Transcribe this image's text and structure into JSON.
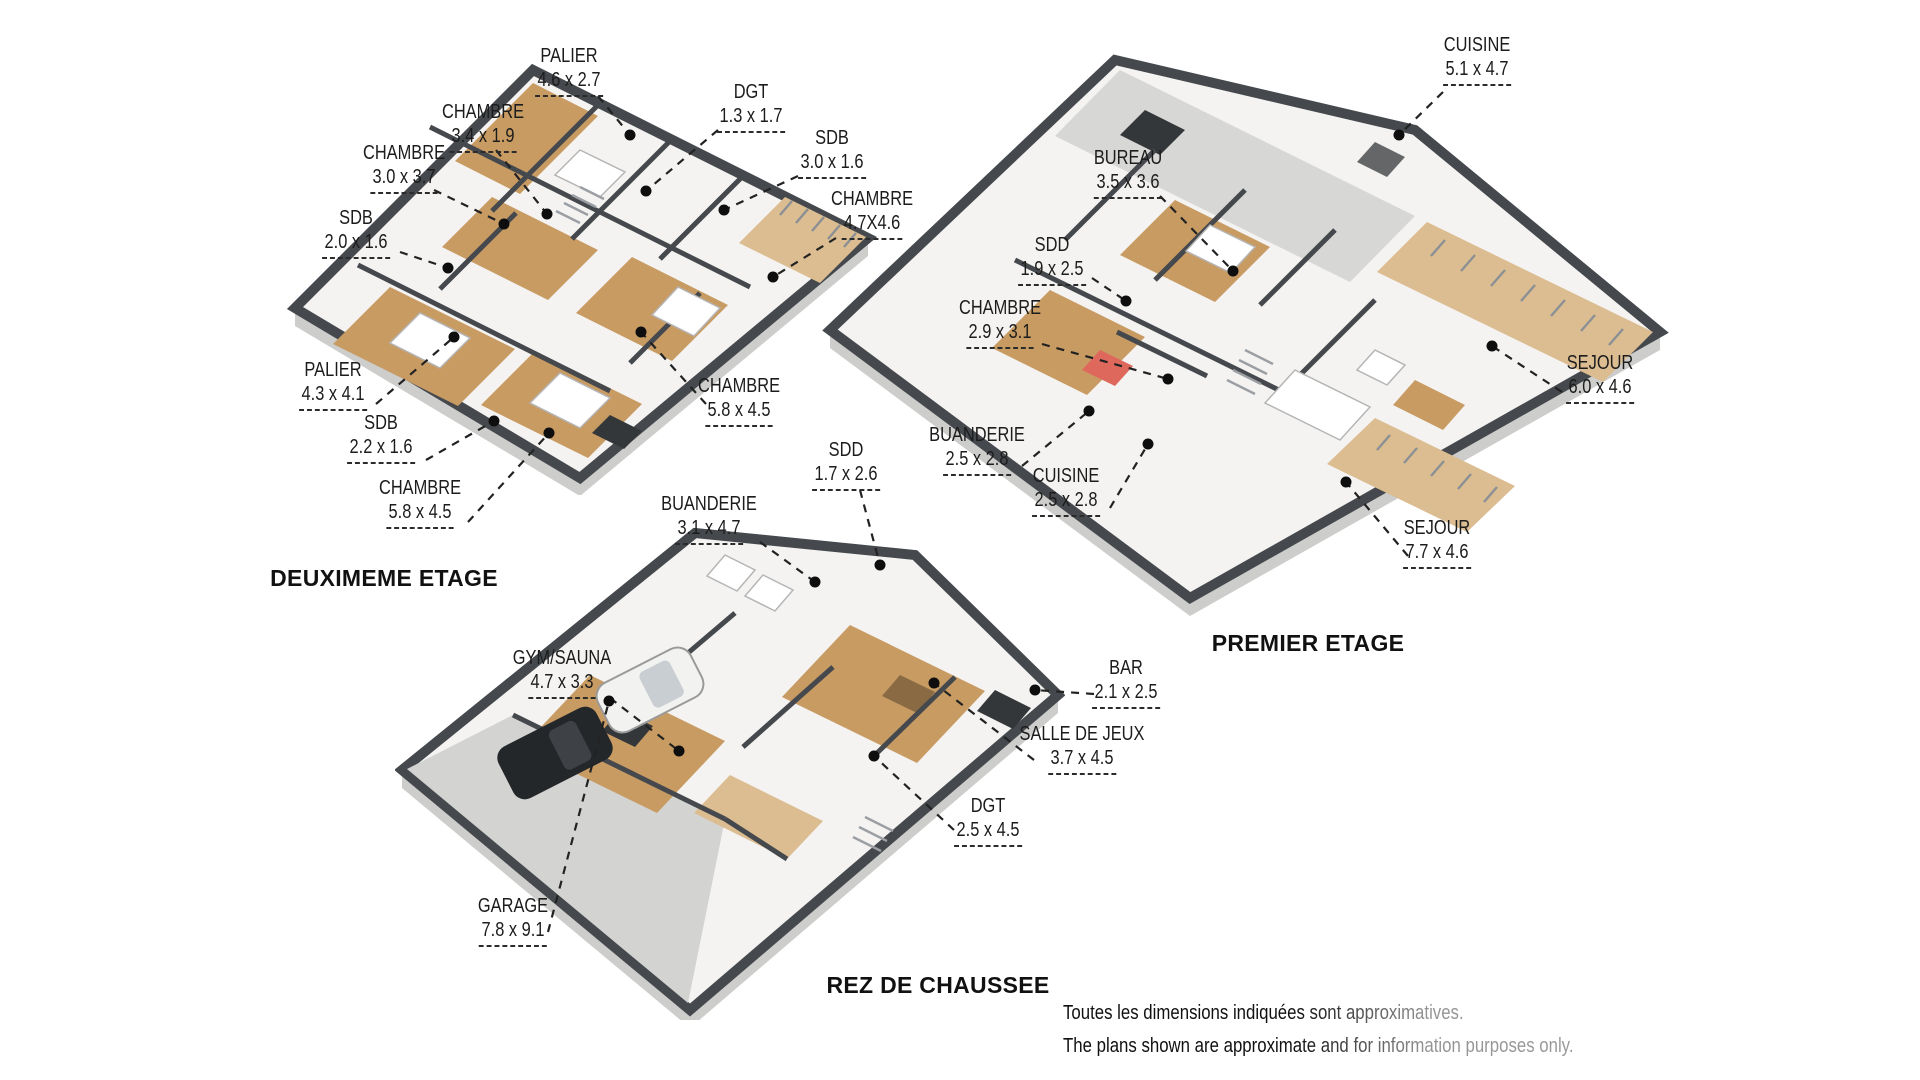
{
  "page": {
    "background": "#ffffff"
  },
  "floors": [
    {
      "id": "deuxieme-etage",
      "title": "DEUXIMEME ETAGE",
      "rooms": [
        {
          "name": "PALIER",
          "dims": "4.6 x 2.7"
        },
        {
          "name": "DGT",
          "dims": "1.3 x 1.7"
        },
        {
          "name": "CHAMBRE",
          "dims": "3.4 x 1.9"
        },
        {
          "name": "CHAMBRE",
          "dims": "3.0 x 3.7"
        },
        {
          "name": "SDB",
          "dims": "3.0 x 1.6"
        },
        {
          "name": "CHAMBRE",
          "dims": "4.7X4.6"
        },
        {
          "name": "SDB",
          "dims": "2.0 x 1.6"
        },
        {
          "name": "PALIER",
          "dims": "4.3 x 4.1"
        },
        {
          "name": "SDB",
          "dims": "2.2 x 1.6"
        },
        {
          "name": "CHAMBRE",
          "dims": "5.8 x 4.5"
        },
        {
          "name": "CHAMBRE",
          "dims": "5.8 x 4.5"
        }
      ]
    },
    {
      "id": "premier-etage",
      "title": "PREMIER ETAGE",
      "rooms": [
        {
          "name": "CUISINE",
          "dims": "5.1 x 4.7"
        },
        {
          "name": "BUREAU",
          "dims": "3.5 x 3.6"
        },
        {
          "name": "SDD",
          "dims": "1.9 x 2.5"
        },
        {
          "name": "CHAMBRE",
          "dims": "2.9 x 3.1"
        },
        {
          "name": "BUANDERIE",
          "dims": "2.5 x 2.8"
        },
        {
          "name": "CUISINE",
          "dims": "2.5 x 2.8"
        },
        {
          "name": "SEJOUR",
          "dims": "6.0 x 4.6"
        },
        {
          "name": "SEJOUR",
          "dims": "7.7 x 4.6"
        }
      ]
    },
    {
      "id": "rez-de-chaussee",
      "title": "REZ DE CHAUSSEE",
      "rooms": [
        {
          "name": "SDD",
          "dims": "1.7 x 2.6"
        },
        {
          "name": "BUANDERIE",
          "dims": "3.1 x 4.7"
        },
        {
          "name": "GYM/SAUNA",
          "dims": "4.7 x 3.3"
        },
        {
          "name": "BAR",
          "dims": "2.1 x 2.5"
        },
        {
          "name": "SALLE DE JEUX",
          "dims": "3.7 x 4.5"
        },
        {
          "name": "DGT",
          "dims": "2.5 x 4.5"
        },
        {
          "name": "GARAGE",
          "dims": "7.8 x 9.1"
        }
      ]
    }
  ],
  "disclaimer": {
    "line1": "Toutes les dimensions indiquées sont approximatives.",
    "line2": "The plans shown are approximate and for information purposes only."
  },
  "colors": {
    "wall": "#45494d",
    "wood_floor": "#c89b63",
    "light_wood": "#dcbd92",
    "slab_side": "#cdcdcb",
    "interior": "#f4f3f1",
    "tile": "#d7d7d5",
    "concrete": "#d3d3d1",
    "accent_red": "#df685c",
    "leader_ink": "#222222"
  }
}
